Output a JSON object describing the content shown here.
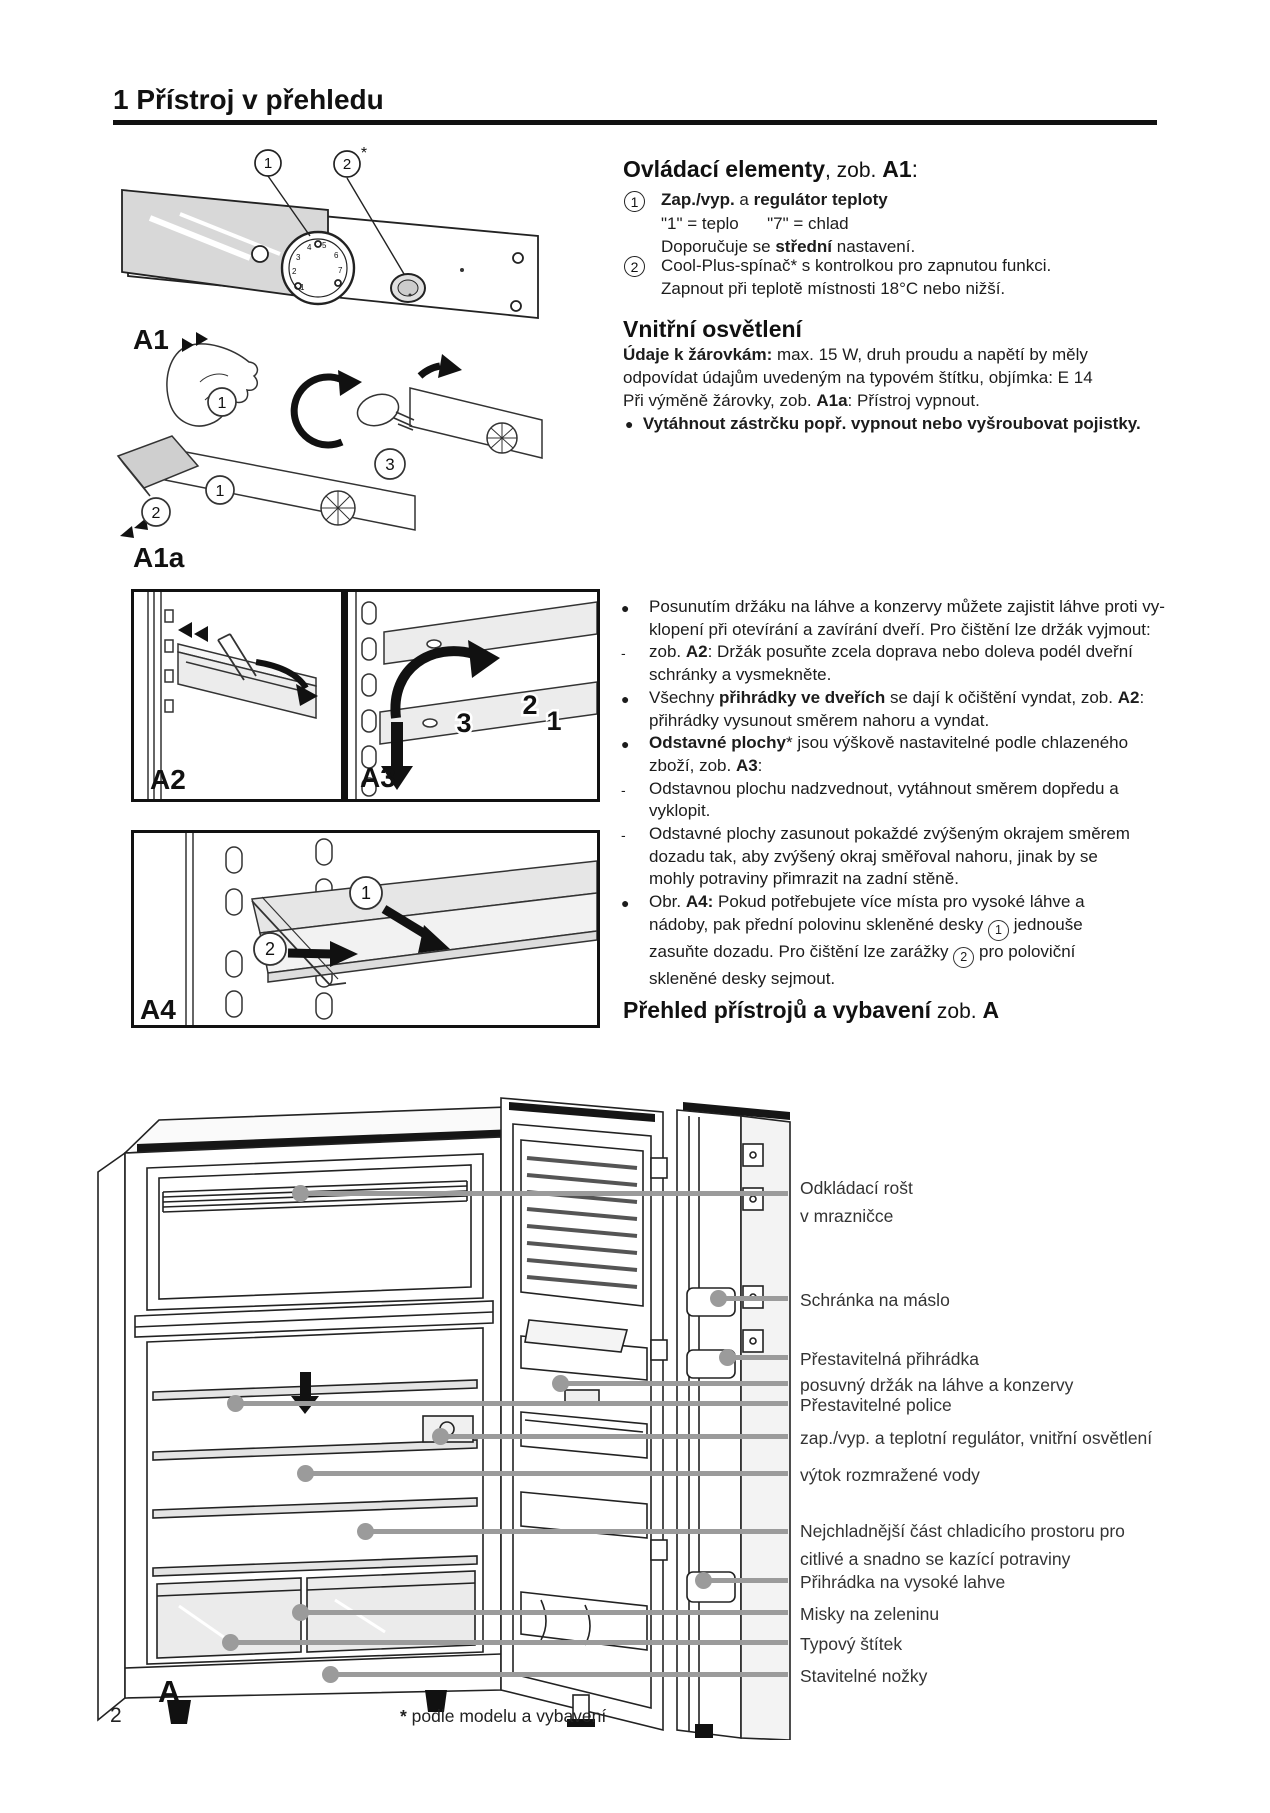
{
  "page": {
    "title": "1 Přístroj v přehledu",
    "number": "2",
    "footnote_star": "*",
    "footnote_text": " podle modelu a vybavení"
  },
  "controls": {
    "heading": {
      "b1": "Ovládací elementy",
      "r1": ", zob. ",
      "b2": "A1",
      "r2": ":"
    },
    "item1": {
      "num": "1",
      "l1": {
        "b1": "Zap./vyp.",
        "r1": " a ",
        "b2": "regulátor teploty"
      },
      "l2": "\"1\" = teplo      \"7\" = chlad",
      "l3": {
        "r1": "Doporučuje se ",
        "b1": "střední",
        "r2": " nastavení."
      }
    },
    "item2": {
      "num": "2",
      "l1": "Cool-Plus-spínač* s kontrolkou pro zapnutou funkci.",
      "l2": "Zapnout při teplotě místnosti 18°C nebo nižší."
    }
  },
  "lighting": {
    "heading": "Vnitřní osvětlení",
    "l1": {
      "b1": "Údaje k žárovkám:",
      "r1": " max. 15 W, druh proudu a napětí by měly"
    },
    "l2": "odpovídat údajům uvedeným na typovém štítku, objímka: E 14",
    "l3": {
      "r1": "Při výměně žárovky, zob. ",
      "b1": "A1a",
      "r2": ": Přístroj vypnout."
    },
    "bullet_marker": "●",
    "bullet": "Vytáhnout zástrčku popř. vypnout nebo vyšroubovat pojistky."
  },
  "tips": [
    {
      "marker": "●",
      "lines": [
        {
          "r1": "Posunutím držáku na láhve a konzervy můžete zajistit láhve proti vy-"
        },
        {
          "r1": "klopení při otevírání a zavírání dveří. Pro čištění lze držák vyjmout:"
        }
      ]
    },
    {
      "marker": "-",
      "lines": [
        {
          "r1": "zob. ",
          "b1": "A2",
          "r2": ": Držák posuňte zcela doprava nebo doleva podél dveřní"
        },
        {
          "r1": "schránky a vysmekněte."
        }
      ]
    },
    {
      "marker": "●",
      "lines": [
        {
          "r1": "Všechny ",
          "b1": "přihrádky ve dveřích",
          "r2": " se dají k očištění vyndat, zob. ",
          "b2": "A2",
          "r3": ":"
        },
        {
          "r1": "přihrádky vysunout směrem nahoru a vyndat."
        }
      ]
    },
    {
      "marker": "●",
      "lines": [
        {
          "b1": "Odstavné plochy",
          "r1": "* jsou výškově nastavitelné podle chlazeného"
        },
        {
          "r1": "zboží, zob. ",
          "b1": "A3",
          "r2": ":"
        }
      ]
    },
    {
      "marker": "-",
      "lines": [
        {
          "r1": "Odstavnou plochu nadzvednout, vytáhnout směrem dopředu a"
        },
        {
          "r1": "vyklopit."
        }
      ]
    },
    {
      "marker": "-",
      "lines": [
        {
          "r1": "Odstavné plochy zasunout pokaždé zvýšeným okrajem směrem"
        },
        {
          "r1": "dozadu tak, aby zvýšený okraj směřoval nahoru, jinak by se"
        },
        {
          "r1": "mohly potraviny přimrazit na zadní stěně."
        }
      ]
    },
    {
      "marker": "●",
      "lines": [
        {
          "r1": "Obr. ",
          "b1": "A4:",
          "r2": " Pokud potřebujete více místa pro vysoké láhve a"
        },
        {
          "r1": "nádoby, pak přední polovinu skleněné desky ",
          "c1": "1",
          "r2": " jednouše"
        },
        {
          "r1": "zasuňte dozadu. Pro čištění lze zarážky ",
          "c1": "2",
          "r2": " pro poloviční"
        },
        {
          "r1": "skleněné desky sejmout."
        }
      ]
    }
  ],
  "overview_heading": {
    "b1": "Přehled přístrojů a vybavení",
    "r1": " zob. ",
    "b2": "A"
  },
  "figures": {
    "a1": {
      "label": "A1",
      "n1": "1",
      "n2": "2",
      "star": "*",
      "dial": [
        "1",
        "2",
        "3",
        "4",
        "5",
        "6",
        "7"
      ]
    },
    "a1a": {
      "label": "A1a",
      "n1": "1",
      "n1b": "1",
      "n2": "2",
      "n3": "3"
    },
    "a23": {
      "label_a2": "A2",
      "label_a3": "A3",
      "n1": "1",
      "n2": "2",
      "n3": "3"
    },
    "a4": {
      "label": "A4",
      "n1": "1",
      "n2": "2"
    },
    "a": {
      "label": "A"
    }
  },
  "callouts": [
    {
      "l1": "Odkládací rošt",
      "l2": "v mrazničce"
    },
    {
      "l1": "Schránka na máslo"
    },
    {
      "l1": "Přestavitelná přihrádka"
    },
    {
      "l1": "posuvný držák na láhve a konzervy"
    },
    {
      "l1": "Přestavitelné police"
    },
    {
      "l1": "zap./vyp. a teplotní regulátor, vnitřní osvětlení"
    },
    {
      "l1": "výtok rozmražené vody"
    },
    {
      "l1": "Nejchladnější část chladicího prostoru pro",
      "l2": "citlivé a snadno se kazící potraviny"
    },
    {
      "l1": "Přihrádka na vysoké lahve"
    },
    {
      "l1": "Misky na zeleninu"
    },
    {
      "l1": "Typový štítek"
    },
    {
      "l1": "Stavitelné nožky"
    }
  ]
}
